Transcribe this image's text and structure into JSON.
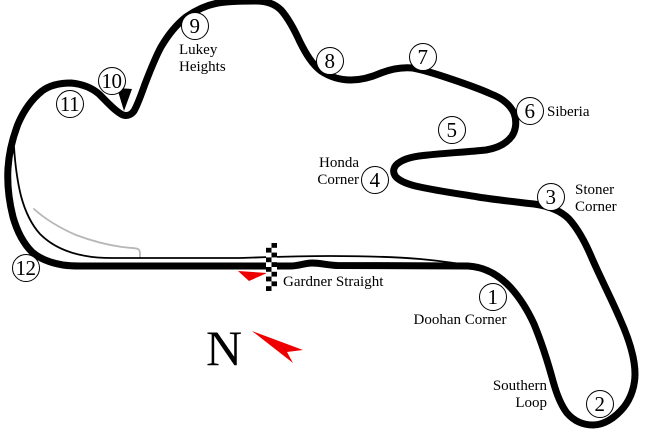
{
  "figure_type": "race-circuit-track-map",
  "colors": {
    "track": "#000000",
    "pit_lane": "#000000",
    "access_road": "#b7b7b7",
    "arrow_red": "#ee0000",
    "background": "#ffffff"
  },
  "compass": {
    "letter": "N"
  },
  "straight_label": "Gardner Straight",
  "track": {
    "main_path": "M 80,266 L 290,266 C 300,266 304,263 312,263 C 320,263 327,265 337,265.5 L 468,266 C 486,267 500,276 511,288 C 520,298 528,311 534,324 C 541,341 547,359 553,381 C 556,392 560,404 567,413 C 574,421 583,425 593,425 C 604,425 615,418 624,407 C 631,398 635,386 635,374 C 635,358 629,339 620,319 C 611,298 600,277 591,256 C 585,242 578,229 569,219 C 561,211 549,206 534,204 C 517,202 497,200 478,197 C 460,194 438,191 420,187 C 410,185 401,182 396,177 C 392,172 393,166 400,162 C 406,158 416,156 428,155 C 446,153 467,152 486,150 C 498,148 507,143 512,136 C 516,130 517,121 514,113 C 510,105 502,98 491,94 C 478,88 463,83 448,78 C 436,74 424,70 413,68 C 402,67 391,69 381,73 C 372,77 362,80 351,80 C 340,80 330,77 321,71 C 312,64 306,54 300,42 C 295,31 289,19 281,10 C 275,4 266,1 256,1 C 243,1 230,1 218,3 C 207,5 196,10 186,17 C 176,25 168,35 161,47 C 155,58 150,71 145,84 C 141,95 138,104 134,111 C 131,115 126,117 121,114 C 114,110 107,102 99,94 C 92,88 82,84 71,83 C 60,83 50,85 42,91 C 32,99 24,110 18,124 C 13,137 9,152 8,168 C 7,184 9,201 13,217 C 17,231 23,243 32,252 C 40,259 51,263 63,265 C 70,266 76,266 80,266 Z",
    "pit_lane_path": "M 14,147 C 15,162 17,180 21,196 C 25,211 31,224 40,234 C 52,246 68,253 86,256 C 96,258 104,258 112,258 L 240,258 C 270,257 300,256 330,256 C 360,256 395,257 420,259 C 440,261 458,263 472,266",
    "access_road_path": "M 34,209 C 45,219 60,228 76,235 C 92,241 108,245 122,247 C 130,248 136,248 138,249 C 140,250 140,252 140,257",
    "turn10_wedge_points": "117,88 132,89 124,111",
    "direction_arrow_points": "238,271 267,273 249,281",
    "compass_arrow_points": "252,331 303,350 287,352 293,363"
  },
  "corners": [
    {
      "number": "1",
      "x": 493,
      "y": 297
    },
    {
      "number": "2",
      "x": 600,
      "y": 404
    },
    {
      "number": "3",
      "x": 551,
      "y": 197
    },
    {
      "number": "4",
      "x": 375,
      "y": 180
    },
    {
      "number": "5",
      "x": 452,
      "y": 130
    },
    {
      "number": "6",
      "x": 530,
      "y": 111
    },
    {
      "number": "7",
      "x": 423,
      "y": 57
    },
    {
      "number": "8",
      "x": 330,
      "y": 61
    },
    {
      "number": "9",
      "x": 195,
      "y": 26
    },
    {
      "number": "10",
      "x": 112,
      "y": 81
    },
    {
      "number": "11",
      "x": 70,
      "y": 104
    },
    {
      "number": "12",
      "x": 26,
      "y": 268
    }
  ],
  "corner_labels": [
    {
      "lines": [
        "Doohan Corner"
      ],
      "x": 460,
      "y": 312,
      "align": "center"
    },
    {
      "lines": [
        "Southern",
        "Loop"
      ],
      "x": 547,
      "y": 378,
      "align": "right"
    },
    {
      "lines": [
        "Stoner",
        "Corner"
      ],
      "x": 575,
      "y": 182,
      "align": "left"
    },
    {
      "lines": [
        "Honda",
        "Corner"
      ],
      "x": 359,
      "y": 155,
      "align": "right"
    },
    {
      "lines": [
        "Siberia"
      ],
      "x": 547,
      "y": 104,
      "align": "left"
    },
    {
      "lines": [
        "Lukey",
        "Heights"
      ],
      "x": 179,
      "y": 42,
      "align": "left"
    }
  ]
}
